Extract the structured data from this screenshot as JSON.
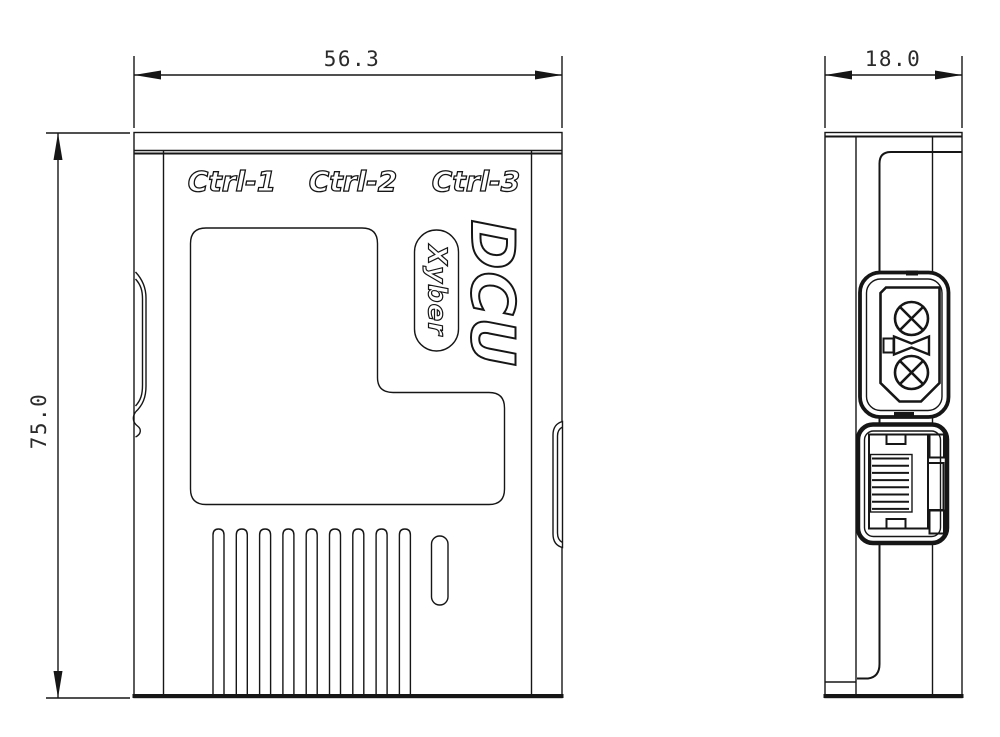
{
  "front_view": {
    "port_labels": [
      "Ctrl-1",
      "Ctrl-2",
      "Ctrl-3"
    ],
    "product_name": "DCU",
    "brand": "Xyber"
  },
  "dimensions": {
    "width": "56.3",
    "height": "75.0",
    "depth": "18.0"
  },
  "colors": {
    "line": "#161616",
    "background": "#ffffff"
  }
}
